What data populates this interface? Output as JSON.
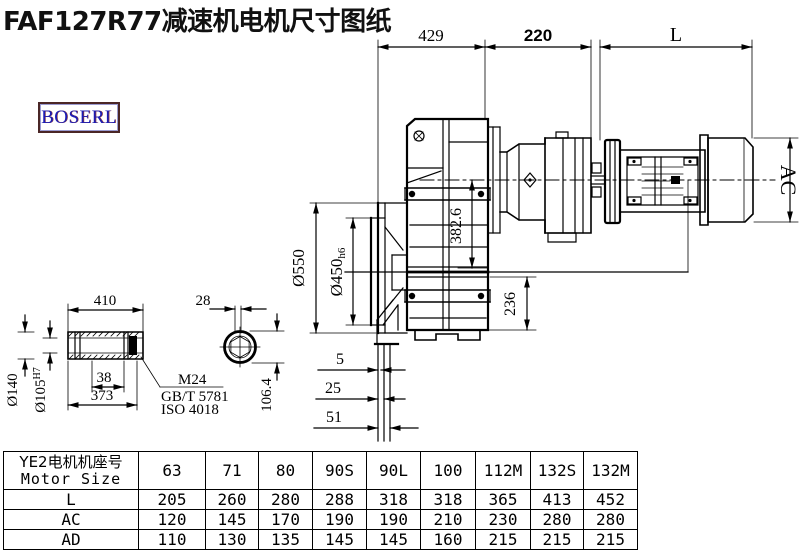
{
  "title": "FAF127R77减速机电机尺寸图纸",
  "logo": "BOSERL",
  "colors": {
    "line": "#000000",
    "logo_text": "#1c1cb5",
    "logo_border": "#4a2626",
    "bg": "#ffffff"
  },
  "dims": {
    "d429": "429",
    "d220": "220",
    "dL": "L",
    "dAC": "AC",
    "d550": "Ø550",
    "d450": "Ø450",
    "d450s": "h6",
    "d382": "382.6",
    "d236": "236",
    "d5": "5",
    "d25": "25",
    "d51": "51",
    "d410": "410",
    "d140": "Ø140",
    "d105": "Ø105",
    "d105s": "H7",
    "d38": "38",
    "d373": "373",
    "d28": "28",
    "d1064": "106.4",
    "m24": "M24",
    "gb": "GB/T 5781",
    "iso": "ISO 4018"
  },
  "table": {
    "header_cn": "YE2电机机座号",
    "header_en": "Motor Size",
    "columns": [
      "63",
      "71",
      "80",
      "90S",
      "90L",
      "100",
      "112M",
      "132S",
      "132M"
    ],
    "rows": [
      {
        "label": "L",
        "values": [
          "205",
          "260",
          "280",
          "288",
          "318",
          "318",
          "365",
          "413",
          "452"
        ]
      },
      {
        "label": "AC",
        "values": [
          "120",
          "145",
          "170",
          "190",
          "190",
          "210",
          "230",
          "280",
          "280"
        ]
      },
      {
        "label": "AD",
        "values": [
          "110",
          "130",
          "135",
          "145",
          "145",
          "160",
          "215",
          "215",
          "215"
        ]
      }
    ]
  }
}
